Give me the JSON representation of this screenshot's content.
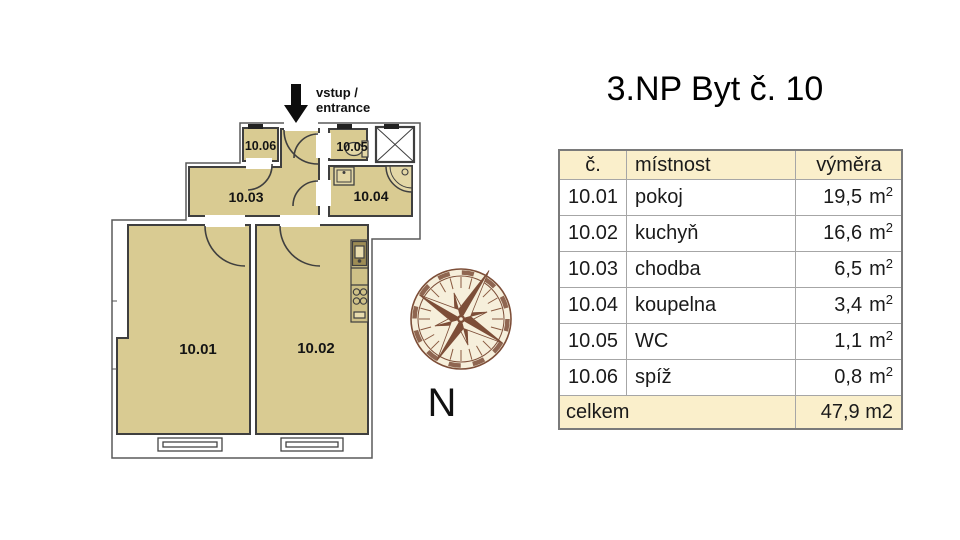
{
  "title": "3.NP Byt č. 10",
  "plan": {
    "entrance_line1": "vstup /",
    "entrance_line2": "entrance",
    "compass_label": "N",
    "room_labels": {
      "r1001": "10.01",
      "r1002": "10.02",
      "r1003": "10.03",
      "r1004": "10.04",
      "r1005": "10.05",
      "r1006": "10.06"
    }
  },
  "table": {
    "headers": {
      "number": "č.",
      "room": "místnost",
      "area": "výměra"
    },
    "rows": [
      {
        "number": "10.01",
        "room": "pokoj",
        "area": "19,5",
        "unit": "m",
        "unit_sup": "2"
      },
      {
        "number": "10.02",
        "room": "kuchyň",
        "area": "16,6",
        "unit": "m",
        "unit_sup": "2"
      },
      {
        "number": "10.03",
        "room": "chodba",
        "area": "6,5",
        "unit": "m",
        "unit_sup": "2"
      },
      {
        "number": "10.04",
        "room": "koupelna",
        "area": "3,4",
        "unit": "m",
        "unit_sup": "2"
      },
      {
        "number": "10.05",
        "room": "WC",
        "area": "1,1",
        "unit": "m",
        "unit_sup": "2"
      },
      {
        "number": "10.06",
        "room": "spíž",
        "area": "0,8",
        "unit": "m",
        "unit_sup": "2"
      }
    ],
    "footer": {
      "label": "celkem",
      "total": "47,9 m2"
    }
  },
  "colors": {
    "room_fill": "#d9cb92",
    "wall": "#3f3f3f",
    "table_header_bg": "#faefcb",
    "compass_brown": "#7d4e38"
  }
}
